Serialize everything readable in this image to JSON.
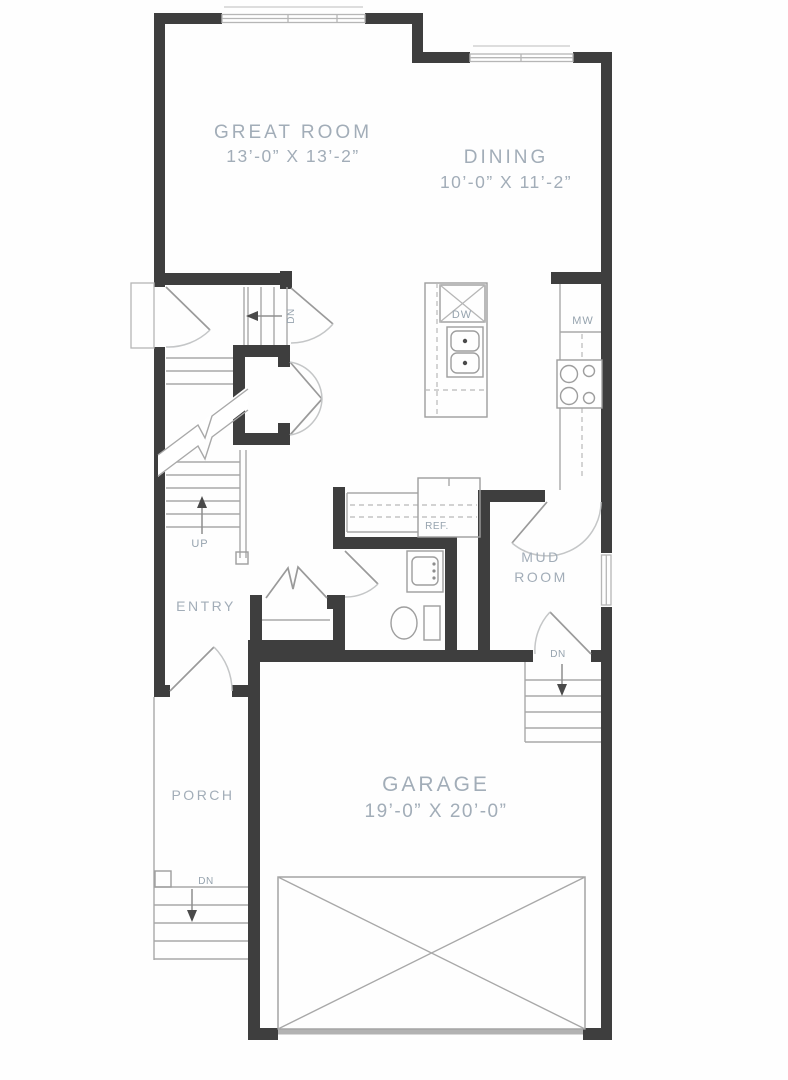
{
  "rooms": {
    "great_room": {
      "name": "GREAT ROOM",
      "dims": "13’-0” X 13’-2”"
    },
    "dining": {
      "name": "DINING",
      "dims": "10’-0” X 11’-2”"
    },
    "entry": {
      "name": "ENTRY"
    },
    "mud_room": {
      "line1": "MUD",
      "line2": "ROOM"
    },
    "porch": {
      "name": "PORCH"
    },
    "garage": {
      "name": "GARAGE",
      "dims": "19’-0” X 20’-0”"
    }
  },
  "labels": {
    "dishwasher": "DW",
    "microwave": "MW",
    "refrigerator": "REF.",
    "stairs_up": "UP",
    "stairs_down": "DN"
  },
  "colors": {
    "wall": "#3e3e3e",
    "line": "#a8a8a8",
    "door": "#c4c6c7",
    "label": "#a2adb8",
    "small_label": "#96a3ae",
    "arrow": "#4a4a4a",
    "garage_door": "#b2b2b2"
  }
}
